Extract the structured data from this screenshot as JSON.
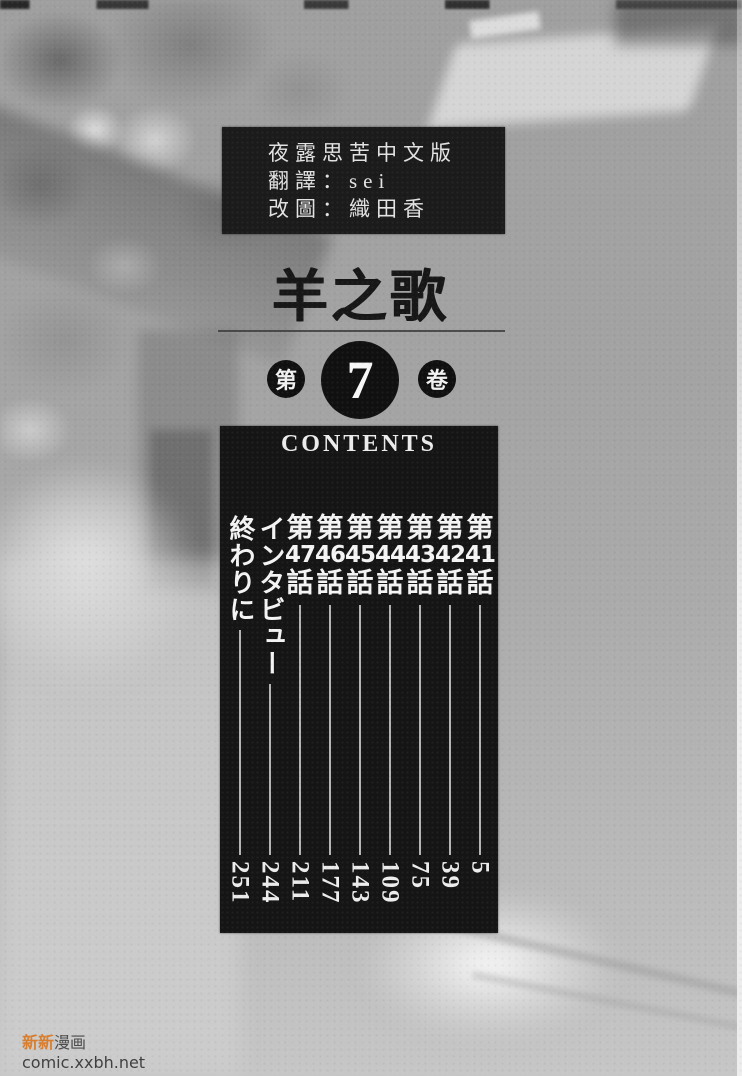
{
  "credit_box": {
    "lines": [
      "夜露思苦中文版",
      "翻譯：sei",
      "改圖：織田香"
    ]
  },
  "title": "羊之歌",
  "volume": {
    "prefix": "第",
    "number": "7",
    "suffix": "卷"
  },
  "contents": {
    "header": "CONTENTS",
    "items": [
      {
        "type": "chapter",
        "prefix": "第",
        "num": "41",
        "suffix": "話",
        "page": "5"
      },
      {
        "type": "chapter",
        "prefix": "第",
        "num": "42",
        "suffix": "話",
        "page": "39"
      },
      {
        "type": "chapter",
        "prefix": "第",
        "num": "43",
        "suffix": "話",
        "page": "75"
      },
      {
        "type": "chapter",
        "prefix": "第",
        "num": "44",
        "suffix": "話",
        "page": "109"
      },
      {
        "type": "chapter",
        "prefix": "第",
        "num": "45",
        "suffix": "話",
        "page": "143"
      },
      {
        "type": "chapter",
        "prefix": "第",
        "num": "46",
        "suffix": "話",
        "page": "177"
      },
      {
        "type": "chapter",
        "prefix": "第",
        "num": "47",
        "suffix": "話",
        "page": "211"
      },
      {
        "type": "text",
        "label": "インタビュー",
        "page": "244"
      },
      {
        "type": "text",
        "label": "終わりに",
        "page": "251"
      }
    ]
  },
  "watermark": {
    "accent_text": "新新",
    "rest_text": "漫画",
    "url": "comic.xxbh.net"
  },
  "colors": {
    "watermark_accent": "#d97e2e",
    "contents_bg": "#151515",
    "label_text": "#f4f4f4",
    "page_number_text": "#ececec"
  }
}
